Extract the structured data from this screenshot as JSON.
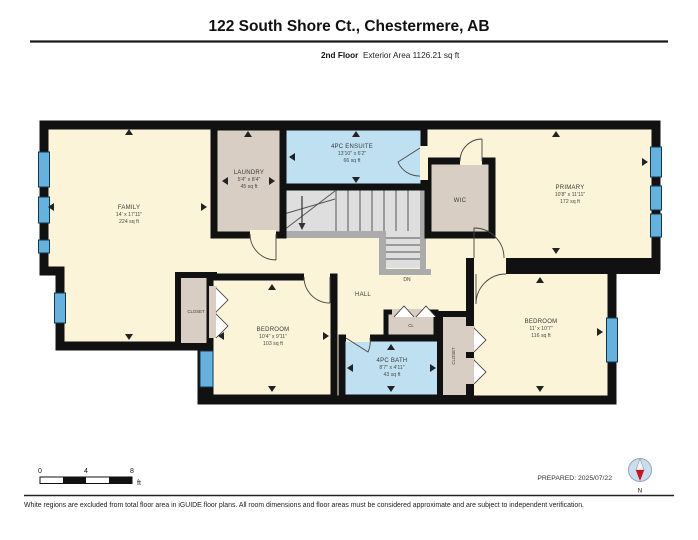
{
  "header": {
    "title": "122 South Shore Ct., Chestermere, AB",
    "floor": "2nd Floor",
    "area": "Exterior Area 1126.21 sq ft"
  },
  "rooms": {
    "family": {
      "name": "FAMILY",
      "dims": "14' x 17'11\"",
      "area": "224 sq ft"
    },
    "laundry": {
      "name": "LAUNDRY",
      "dims": "5'4\" x 8'4\"",
      "area": "45 sq ft"
    },
    "ensuite": {
      "name": "4PC ENSUITE",
      "dims": "13'10\" x 6'2\"",
      "area": "66 sq ft"
    },
    "wic": {
      "name": "WIC"
    },
    "primary": {
      "name": "PRIMARY",
      "dims": "10'8\" x 11'11\"",
      "area": "172 sq ft"
    },
    "hall": {
      "name": "HALL"
    },
    "stairs": {
      "dn": "DN"
    },
    "closet_left": {
      "name": "CLOSET"
    },
    "bedroom_left": {
      "name": "BEDROOM",
      "dims": "10'4\" x 9'11\"",
      "area": "103 sq ft"
    },
    "cl": {
      "name": "CL"
    },
    "bath": {
      "name": "4PC BATH",
      "dims": "8'7\" x 4'11\"",
      "area": "43 sq ft"
    },
    "closet_right": {
      "name": "CLOSET"
    },
    "bedroom_right": {
      "name": "BEDROOM",
      "dims": "11' x 10'7\"",
      "area": "116 sq ft"
    }
  },
  "scalebar": {
    "t0": "0",
    "t4": "4",
    "t8": "8",
    "unit": "ft"
  },
  "meta": {
    "prepared": "PREPARED: 2025/07/22"
  },
  "compass": {
    "n": "N"
  },
  "footer": {
    "disclaimer": "White regions are excluded from total floor area in iGUIDE floor plans. All room dimensions and floor areas must be considered approximate and are subject to independent verification."
  },
  "colors": {
    "wall": "#111111",
    "floor_cream": "#FBF4D9",
    "wet_blue": "#BFE0F1",
    "closet_tan": "#D8CEC3",
    "window_blue": "#66B2DE",
    "stair_gray": "#DEDEDE",
    "knee_gray": "#ABABAB",
    "compass_red": "#C5161D"
  }
}
